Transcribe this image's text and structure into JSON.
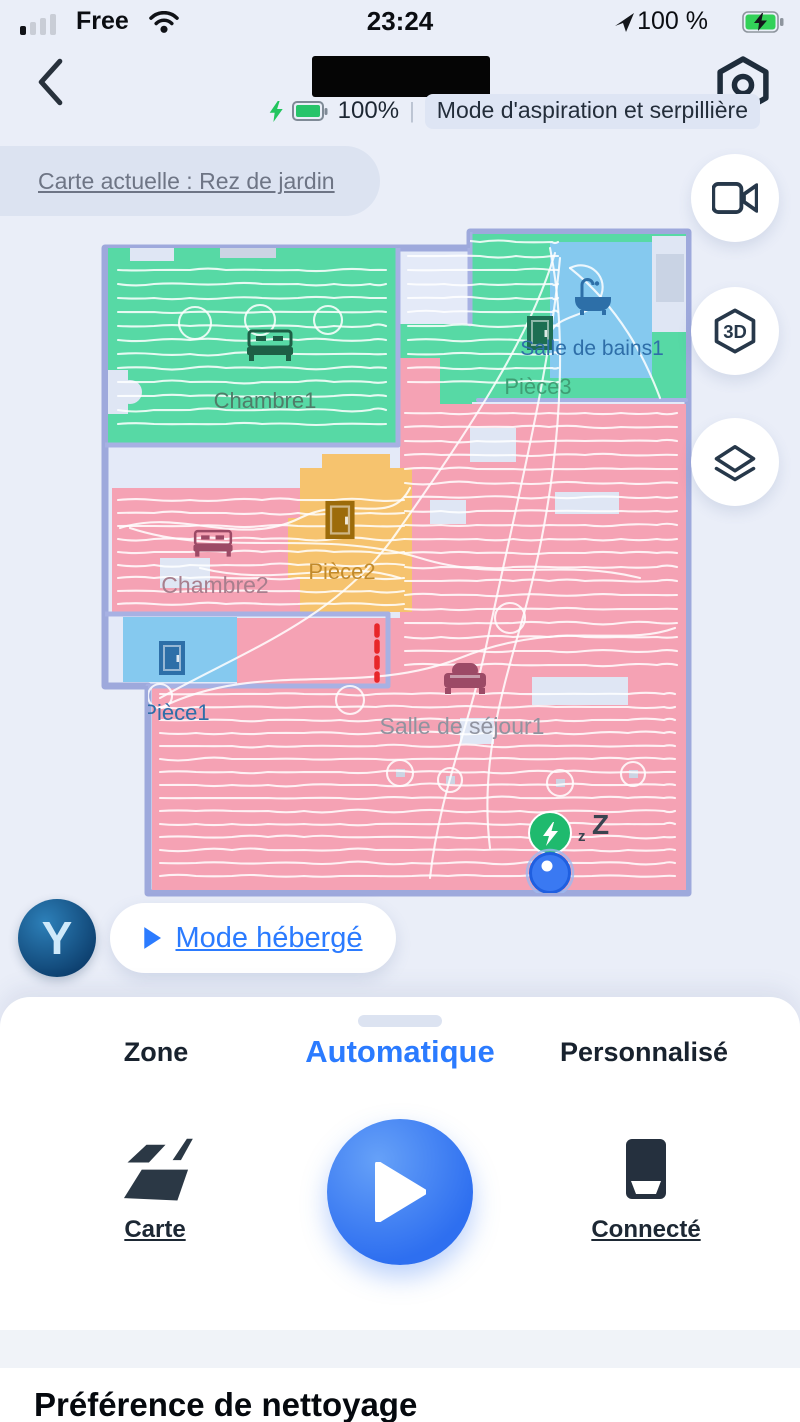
{
  "status_bar": {
    "carrier": "Free",
    "time": "23:24",
    "battery": "100 %"
  },
  "header": {
    "battery_percent": "100%",
    "divider": "|",
    "mode_label": "Mode d'aspiration et serpillière"
  },
  "map_banner": {
    "label": "Carte actuelle : Rez de jardin"
  },
  "map": {
    "rooms": [
      {
        "name": "Chambre1",
        "color": "#57d9a5",
        "label_color": "#4f7d69",
        "icon": "bed-icon",
        "icon_color": "#1d5f46"
      },
      {
        "name": "Salle de bains1",
        "color": "#85c9ef",
        "label_color": "#2e6ea8",
        "icon": "bathtub-icon",
        "icon_color": "#2d6fa8"
      },
      {
        "name": "Pièce3",
        "color": "#57d9a5",
        "label_color": "#3f9e74",
        "icon": "door-icon",
        "icon_color": "#1d6e52"
      },
      {
        "name": "Chambre2",
        "color": "#f5a2b4",
        "label_color": "#a87e8d",
        "icon": "bed-icon",
        "icon_color": "#9c4a66"
      },
      {
        "name": "Pièce2",
        "color": "#f6c36e",
        "label_color": "#c18a2b",
        "icon": "door-icon",
        "icon_color": "#9c6b0a"
      },
      {
        "name": "Pièce1",
        "color": "#85c9ef",
        "label_color": "#2e6ea8",
        "icon": "door-icon",
        "icon_color": "#2d6fa8"
      },
      {
        "name": "Salle de séjour1",
        "color": "#f5a2b4",
        "label_color": "#90939f",
        "icon": "sofa-icon",
        "icon_color": "#9c4a66"
      }
    ],
    "sleep_small": "z",
    "sleep_big": "Z",
    "virtual_wall_color": "#e8262a",
    "dock_color": "#1fba6e",
    "robot_color": "#3a79f2",
    "wall_color": "#a3aee0"
  },
  "side_controls": {
    "video": {
      "icon": "video-camera-icon"
    },
    "view3d": {
      "icon": "3d-view-icon",
      "label": "3D"
    },
    "layers": {
      "icon": "layers-icon"
    }
  },
  "assistant": {
    "avatar_letter": "Y",
    "mode_label": "Mode hébergé"
  },
  "sheet": {
    "tabs": [
      {
        "label": "Zone",
        "active": false
      },
      {
        "label": "Automatique",
        "active": true
      },
      {
        "label": "Personnalisé",
        "active": false
      }
    ],
    "actions": {
      "left": {
        "label": "Carte",
        "icon": "map-icon"
      },
      "center": {
        "icon": "play-icon"
      },
      "right": {
        "label": "Connecté",
        "icon": "dock-station-icon"
      }
    },
    "section_heading": "Préférence de nettoyage"
  },
  "colors": {
    "accent_blue": "#2b7bff",
    "battery_green": "#27c46a",
    "page_bg": "#eaeef8"
  }
}
